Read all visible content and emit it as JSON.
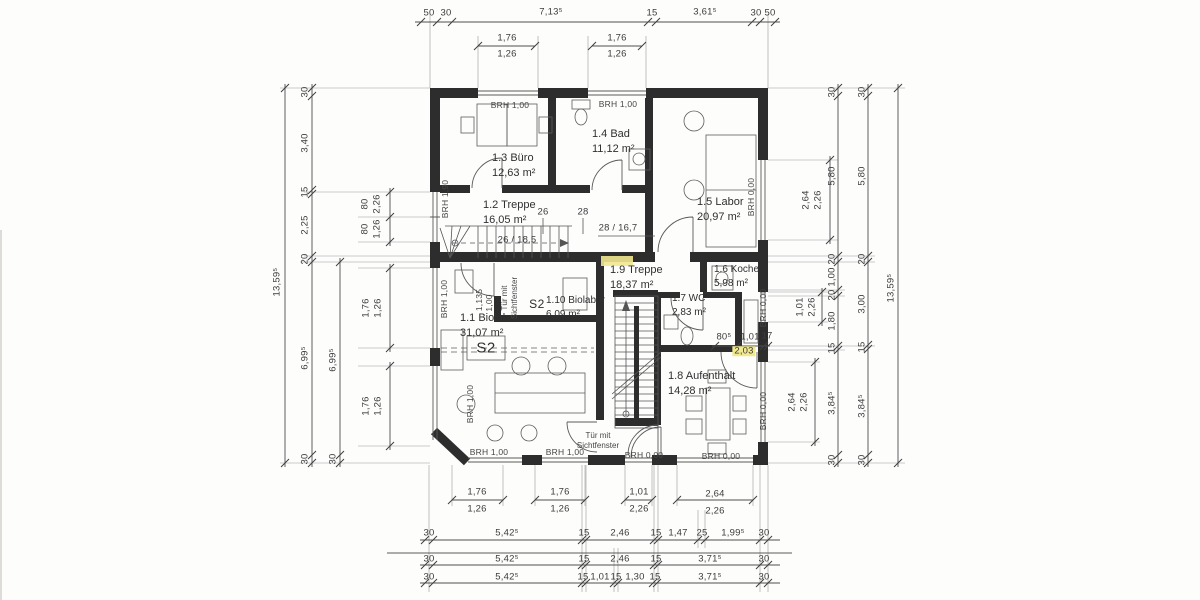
{
  "drawing": {
    "title_hint": "floor plan with dimension chains",
    "highlight_color": "#f1e88f",
    "rooms": [
      {
        "name": "1.3 Büro",
        "area": "12,63 m²"
      },
      {
        "name": "1.4 Bad",
        "area": "11,12 m²"
      },
      {
        "name": "1.5 Labor",
        "area": "20,97 m²"
      },
      {
        "name": "1.2 Treppe",
        "area": "16,05 m²"
      },
      {
        "name": "1.9 Treppe",
        "area": "18,37 m²"
      },
      {
        "name": "1.6 Kochen",
        "area": "5,98 m²"
      },
      {
        "name": "1.7 WC",
        "area": "2,83 m²"
      },
      {
        "name": "1.10 Biolabor",
        "area": "6,09 m²"
      },
      {
        "name": "1.1 Biolabor",
        "area": "31,07 m²"
      },
      {
        "name": "1.8 Aufenthalt",
        "area": "14,28 m²"
      }
    ],
    "zone_tags": {
      "s2": "S2"
    },
    "sill_labels": {
      "brh_100": "BRH 1,00",
      "brh_000": "BRH 0,00",
      "brh_190": "BRH 1,90"
    },
    "door_note": "Tür mit Sichtfenster",
    "stair_notes": {
      "tick_26": "26",
      "tick_28": "28",
      "run_upper": "26 / 18,5",
      "run_lower": "28 / 16,7"
    },
    "door_size": {
      "width": "1,135",
      "height": "1,00"
    },
    "hall_dim": {
      "a": "80⁵",
      "b": "1,01",
      "c": "17",
      "highlight": "2,03"
    },
    "dims": {
      "top_chain": [
        "50",
        "30",
        "7,13⁵",
        "15",
        "3,61⁵",
        "30",
        "50"
      ],
      "top_windows": [
        {
          "w": "1,76",
          "s": "1,26"
        },
        {
          "w": "1,76",
          "s": "1,26"
        }
      ],
      "left_total": "13,59⁵",
      "left_chain": [
        "30",
        "3,40",
        "15",
        "2,25",
        "20",
        "6,99⁵",
        "30"
      ],
      "left_chain_inner": [
        "6,99⁵",
        "30"
      ],
      "left_small": [
        {
          "w": "80",
          "s": "2,26"
        },
        {
          "w": "80",
          "s": "1,26"
        }
      ],
      "left_windows": [
        {
          "w": "1,76",
          "s": "1,26"
        },
        {
          "w": "1,76",
          "s": "1,26"
        }
      ],
      "right_windows": [
        {
          "w": "2,64",
          "s": "2,26"
        },
        {
          "w": "1,01",
          "s": "2,26"
        },
        {
          "w": "2,64",
          "s": "2,26"
        }
      ],
      "right_chain_inner": [
        "30",
        "5,80",
        "20",
        "1,00",
        "20",
        "1,80",
        "15",
        "3,84⁵",
        "30"
      ],
      "right_chain_outer": [
        "30",
        "5,80",
        "20",
        "3,00",
        "15",
        "3,84⁵",
        "30"
      ],
      "right_total": "13,59⁵",
      "bottom_windows": [
        {
          "w": "1,76",
          "s": "1,26"
        },
        {
          "w": "1,76",
          "s": "1,26"
        },
        {
          "w": "1,01",
          "s": "2,26"
        },
        {
          "w": "2,64",
          "s": "2,26"
        }
      ],
      "bottom_chain1": [
        "30",
        "5,42⁵",
        "15",
        "2,46",
        "15",
        "1,47",
        "25",
        "1,99⁵",
        "30"
      ],
      "bottom_chain2": [
        "30",
        "5,42⁵",
        "15",
        "2,46",
        "15",
        "3,71⁵",
        "30"
      ],
      "bottom_chain3": [
        "30",
        "5,42⁵",
        "15",
        "1,01",
        "15",
        "1,30",
        "15",
        "3,71⁵",
        "30"
      ]
    }
  }
}
